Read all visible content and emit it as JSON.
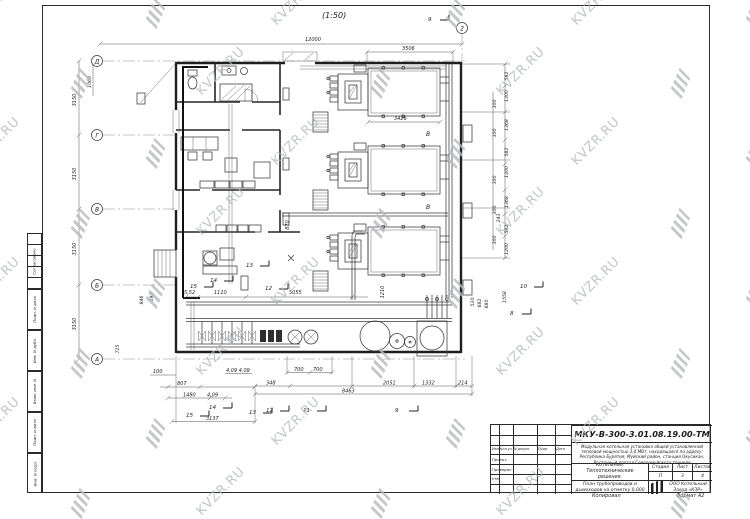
{
  "watermark": {
    "text": "KVZR.RU",
    "logo_name": "kvzr-logo"
  },
  "drawing": {
    "scale_label": "(1:50)",
    "grid_rows": [
      "Д",
      "Г",
      "В",
      "Б",
      "А"
    ],
    "grid_col": "2",
    "section_letters": [
      "В",
      "В"
    ],
    "dims": {
      "top": [
        "12000",
        "3506"
      ],
      "left": [
        "3150",
        "3150",
        "3150",
        "3150",
        "1060",
        "846",
        "593",
        "725"
      ],
      "right": [
        "582",
        "1300",
        "300",
        "1368",
        "300",
        "582",
        "1300",
        "300",
        "1368",
        "300",
        "243",
        "582",
        "300",
        "1200"
      ],
      "far_right": [
        "530",
        "682",
        "680",
        "1558"
      ],
      "bottom": [
        "100",
        "807",
        "1480",
        "4,09",
        "4,09 4,09",
        "348",
        "700",
        "700",
        "8463",
        "2051",
        "1332",
        "214",
        "3137"
      ],
      "inner": [
        "3426",
        "5,52",
        "1110",
        "5055",
        "870",
        "1210"
      ]
    },
    "flags_top": [
      "9"
    ],
    "flags_bottom": [
      "15",
      "14",
      "13",
      "12",
      "11",
      "9"
    ],
    "flags_right": [
      "10",
      "8"
    ],
    "flags_inner": [
      "15",
      "14",
      "13",
      "12"
    ]
  },
  "title_block": {
    "doc_number": "МКУ-В-300-3.01.08.19.00-ТМ",
    "description": "Модульная котельная установка общей установленной тепловой мощностью 3,0 МВт, находящаяся по адресу: Республика Бурятия, Муйский район, станция Окусикан, Восточный портал Северомуйского тоннеля",
    "object_name": "Котельная. Теплотехнические решения.",
    "sheet_name": "План трубопроводов и дымоходов на отметку 0,000",
    "stage_header": [
      "Стадия",
      "Лист",
      "Листов"
    ],
    "stage": "П",
    "sheet": "3",
    "sheets": "4",
    "company": "ООО Котельный Завод «КЗР»",
    "sig_header": [
      "Изм.",
      "Кол.уч",
      "N докум.",
      "Подп.",
      "Дата"
    ],
    "sig_rows": [
      "Проект.",
      "Проверил",
      "Утв."
    ],
    "footer_left": "Копировал",
    "footer_right": "Формат А2"
  },
  "side_strip": {
    "labels": [
      "Согласовано",
      "Подп. и дата",
      "Инв. N дубл.",
      "Взам. инв. N",
      "Подп. и дата",
      "Инв. N подл."
    ]
  }
}
